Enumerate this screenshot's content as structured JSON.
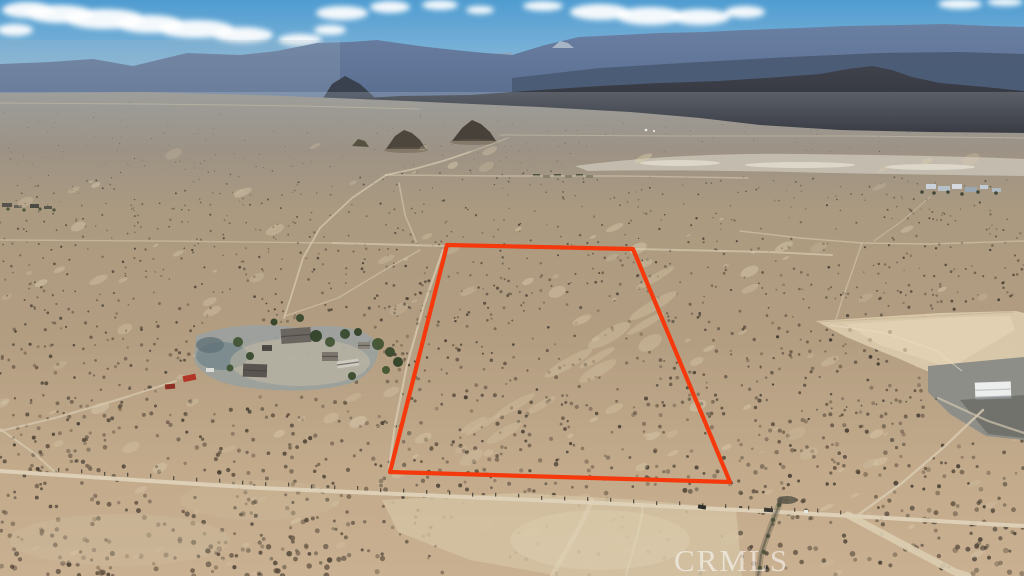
{
  "watermark": {
    "text": "CRMLS"
  },
  "boundary": {
    "color": "#f5390d",
    "stroke_width": 4.2,
    "points": [
      [
        447,
        245
      ],
      [
        633,
        249
      ],
      [
        730,
        482
      ],
      [
        390,
        472
      ]
    ]
  },
  "palette": {
    "sky_top": "#4f9cd1",
    "sky_bottom": "#aac9dd",
    "cloud": "#ffffff",
    "ridge_far": "#8ea4bb",
    "ridge_main_top": "#6a80a2",
    "ridge_main_bottom": "#55688a",
    "ridge_near": "#4a5a74",
    "foothill_top": "#3f414b",
    "foothill_bottom": "#2d2f37",
    "desert_far": "#8f8c86",
    "desert_mid": "#b39d81",
    "desert_near": "#c9b091",
    "playa": "#ccc6b9",
    "road": "#d9ccb2",
    "road_main": "#dfd2b8",
    "shrub_dark": "#3b332a",
    "red_vehicle": "#b23527",
    "building_white": "#eceeed",
    "graded_pavement": "#8e8e88",
    "watermark_color": "rgba(255,255,255,0.55)"
  }
}
